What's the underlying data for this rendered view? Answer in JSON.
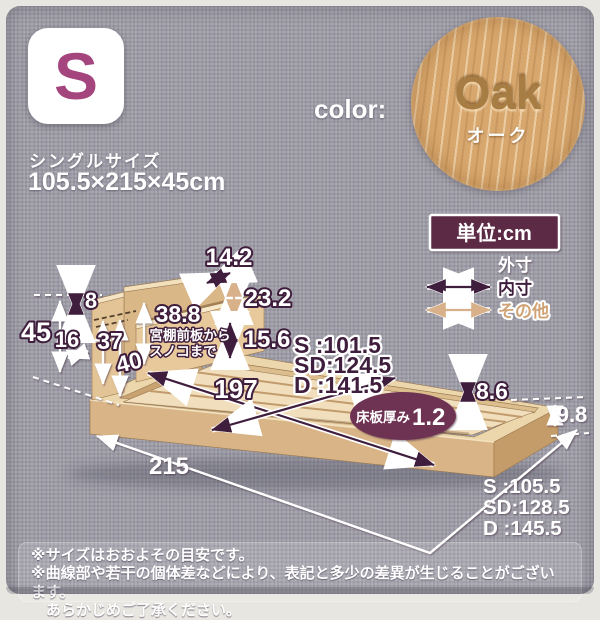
{
  "size_card": {
    "badge": "S",
    "size_label": "シングルサイズ",
    "dimensions": "105.5×215×45cm"
  },
  "color_swatch": {
    "label": "color:",
    "name_en": "Oak",
    "name_jp": "オーク"
  },
  "unit_badge": "単位:cm",
  "legend": {
    "outer": "外寸",
    "inner": "内寸",
    "other": "その他"
  },
  "diagram": {
    "shelf_depth": "14.2",
    "panel_top_thickness": "8",
    "headboard_upper_height": "23.2",
    "shelf_board_gap": "15.6",
    "shelf_note_value": "38.8",
    "shelf_note_line1": "宮棚前板から",
    "shelf_note_line2": "スノコまで",
    "total_height": "45",
    "shelf_opening": "16",
    "height_37": "37",
    "height_40": "40",
    "inner_length": "197",
    "inner_width_s": "S :101.5",
    "inner_width_sd": "SD:124.5",
    "inner_width_d": "D :141.5",
    "frame_inner_height": "8.6",
    "frame_height": "9.8",
    "outer_length": "215",
    "outer_width_s": "S :105.5",
    "outer_width_sd": "SD:128.5",
    "outer_width_d": "D :145.5",
    "floor_plate_label": "床板厚み",
    "floor_plate_value": "1.2"
  },
  "disclaimer": {
    "line1": "※サイズはおおよその目安です。",
    "line2": "※曲線部や若干の個体差などにより、表記と多少の差異が生じることがございます。",
    "line3": "あらかじめご了承ください。"
  },
  "colors": {
    "accent_plum": "#a4457e",
    "badge_maroon": "#5c2b45",
    "dim_dark_purple": "#3f1d3c",
    "dim_tan": "#d8b089",
    "wood_oak": "#d7a76e",
    "fabric_gray": "#9b9aa4"
  }
}
